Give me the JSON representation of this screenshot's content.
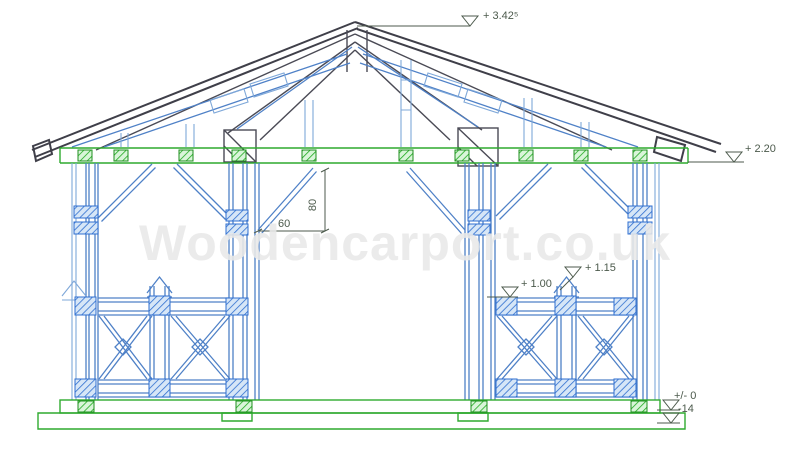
{
  "drawing": {
    "title": "Wooden carport front elevation",
    "watermark": "Woodencarport.co.uk",
    "levels": {
      "ridge": "+ 3.42⁵",
      "eave": "+ 2.20",
      "railing_cap": "+ 1.15",
      "railing": "+ 1.00",
      "ground": "+/- 0",
      "foundation": "-14"
    },
    "dimensions": {
      "brace_width": "60",
      "brace_height": "80"
    },
    "colors": {
      "timber_blue": "#4f81c7",
      "timber_blue_light": "#7fa8d9",
      "plate_green": "#2faa2f",
      "roof_dark": "#3f3f49",
      "annotation_green_gray": "#4c5a4c",
      "watermark_gray": "#e9e9e9"
    }
  }
}
